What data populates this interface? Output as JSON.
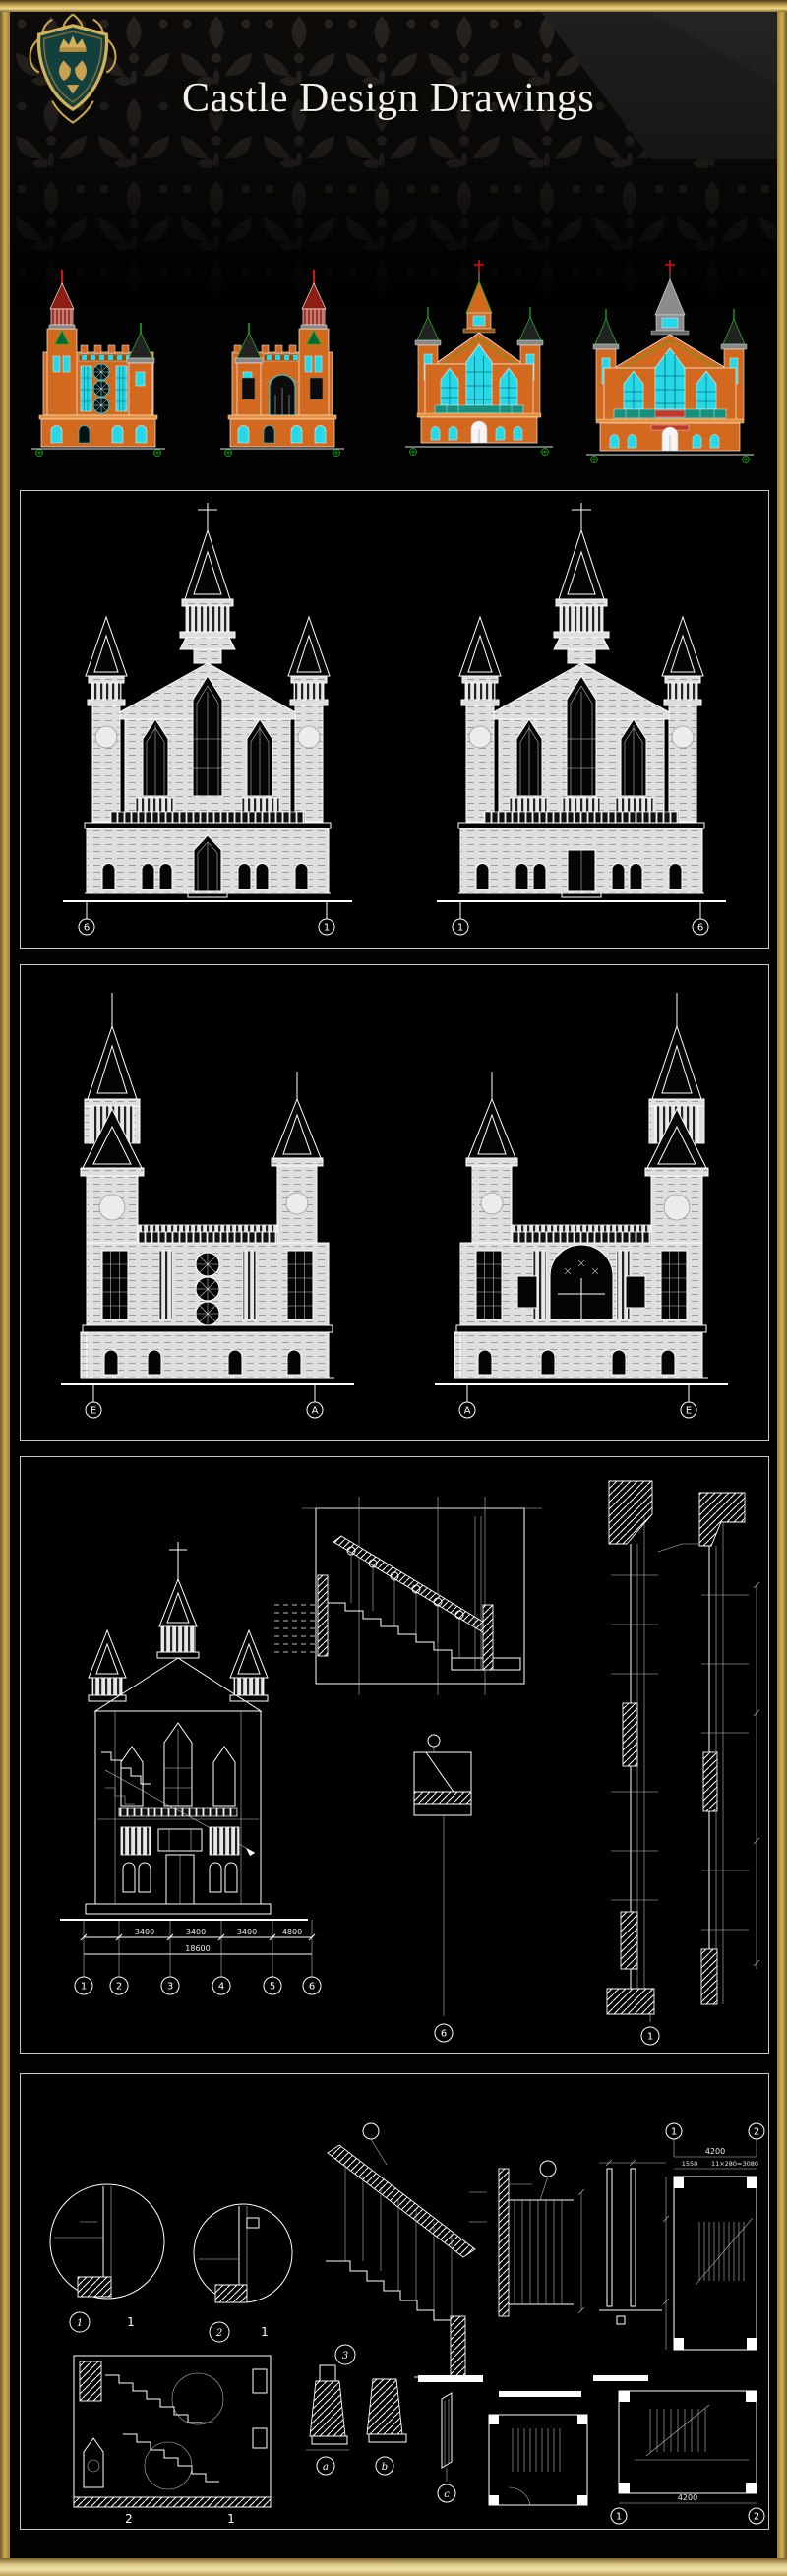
{
  "header": {
    "title": "Castle Design Drawings",
    "logo": "royal-crest-shield"
  },
  "palette": {
    "frame_gold": "#c2a14d",
    "frame_gold_light": "#ecdb95",
    "background": "#000000",
    "castle_orange": "#d2691e",
    "window_cyan": "#25d9e8",
    "spire_red": "#b51d19",
    "accent_green": "#1db31d",
    "cad_line": "#ffffff"
  },
  "colored_row": {
    "items": [
      {
        "name": "castle-elevation-tall-left-tower"
      },
      {
        "name": "castle-elevation-tall-right-tower"
      },
      {
        "name": "church-front-elevation"
      },
      {
        "name": "church-front-elevation-wide"
      }
    ]
  },
  "panel_front_elevations": {
    "left_drawing": {
      "bubbles": [
        "6",
        "1"
      ]
    },
    "right_drawing": {
      "bubbles": [
        "1",
        "6"
      ]
    }
  },
  "panel_side_elevations": {
    "left_drawing": {
      "bubbles": [
        "E",
        "A"
      ]
    },
    "right_drawing": {
      "bubbles": [
        "A",
        "E"
      ]
    }
  },
  "panel_section": {
    "dims": [
      "3400",
      "3400",
      "3400",
      "4800"
    ],
    "total": "18600",
    "grid_bubbles": [
      "1",
      "2",
      "3",
      "4",
      "5",
      "6"
    ],
    "detail_bubbles": [
      "6",
      "1"
    ]
  },
  "panel_details": {
    "detail1": {
      "bubble": "1",
      "ref": "1"
    },
    "detail2": {
      "bubble": "2",
      "ref": "1"
    },
    "detail3": {
      "bubble": "3"
    },
    "letter_bubbles": [
      "a",
      "b",
      "c"
    ],
    "section_labels": [
      "2",
      "1"
    ],
    "plan_top": {
      "bubbles": [
        "1",
        "2"
      ],
      "dim_total": "4200",
      "dim_a": "1550",
      "dim_b": "11×280=3080"
    },
    "plan_bottom": {
      "bubbles": [
        "1",
        "2"
      ],
      "dim_total": "4200"
    }
  }
}
